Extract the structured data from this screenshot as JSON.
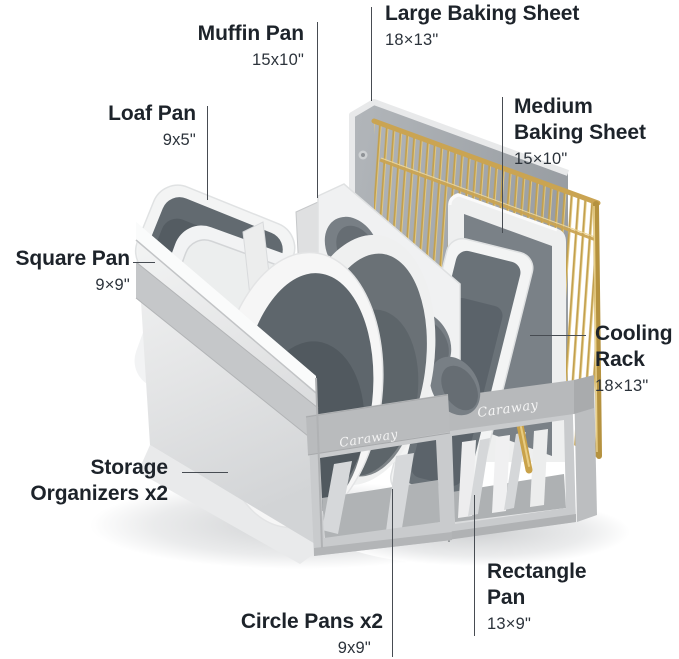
{
  "brand": "Caraway",
  "callouts": {
    "large_baking_sheet": {
      "title": "Large Baking Sheet",
      "size": "18×13\""
    },
    "muffin_pan": {
      "title": "Muffin Pan",
      "size": "15x10\""
    },
    "loaf_pan": {
      "title": "Loaf Pan",
      "size": "9x5\""
    },
    "square_pan": {
      "title": "Square Pan",
      "size": "9×9\""
    },
    "medium_baking_sheet": {
      "title": "Medium Baking Sheet",
      "size": "15×10\""
    },
    "cooling_rack": {
      "title": "Cooling Rack",
      "size": "18×13\""
    },
    "storage_organizers": {
      "title": "Storage Organizers x2"
    },
    "circle_pans": {
      "title": "Circle Pans x2",
      "size": "9x9\""
    },
    "rectangle_pan": {
      "title": "Rectangle Pan",
      "size": "13×9\""
    }
  },
  "colors": {
    "label_text": "#1d232a",
    "connector_line": "#474c52",
    "fabric_gray": "#c9cbcd",
    "band_gray": "#b8babc",
    "pan_white": "#f4f4f4",
    "pan_interior_gray": "#5e666c",
    "gold_accent": "#c2a04e",
    "sheet_gray": "#a8acb0",
    "background": "#ffffff"
  }
}
